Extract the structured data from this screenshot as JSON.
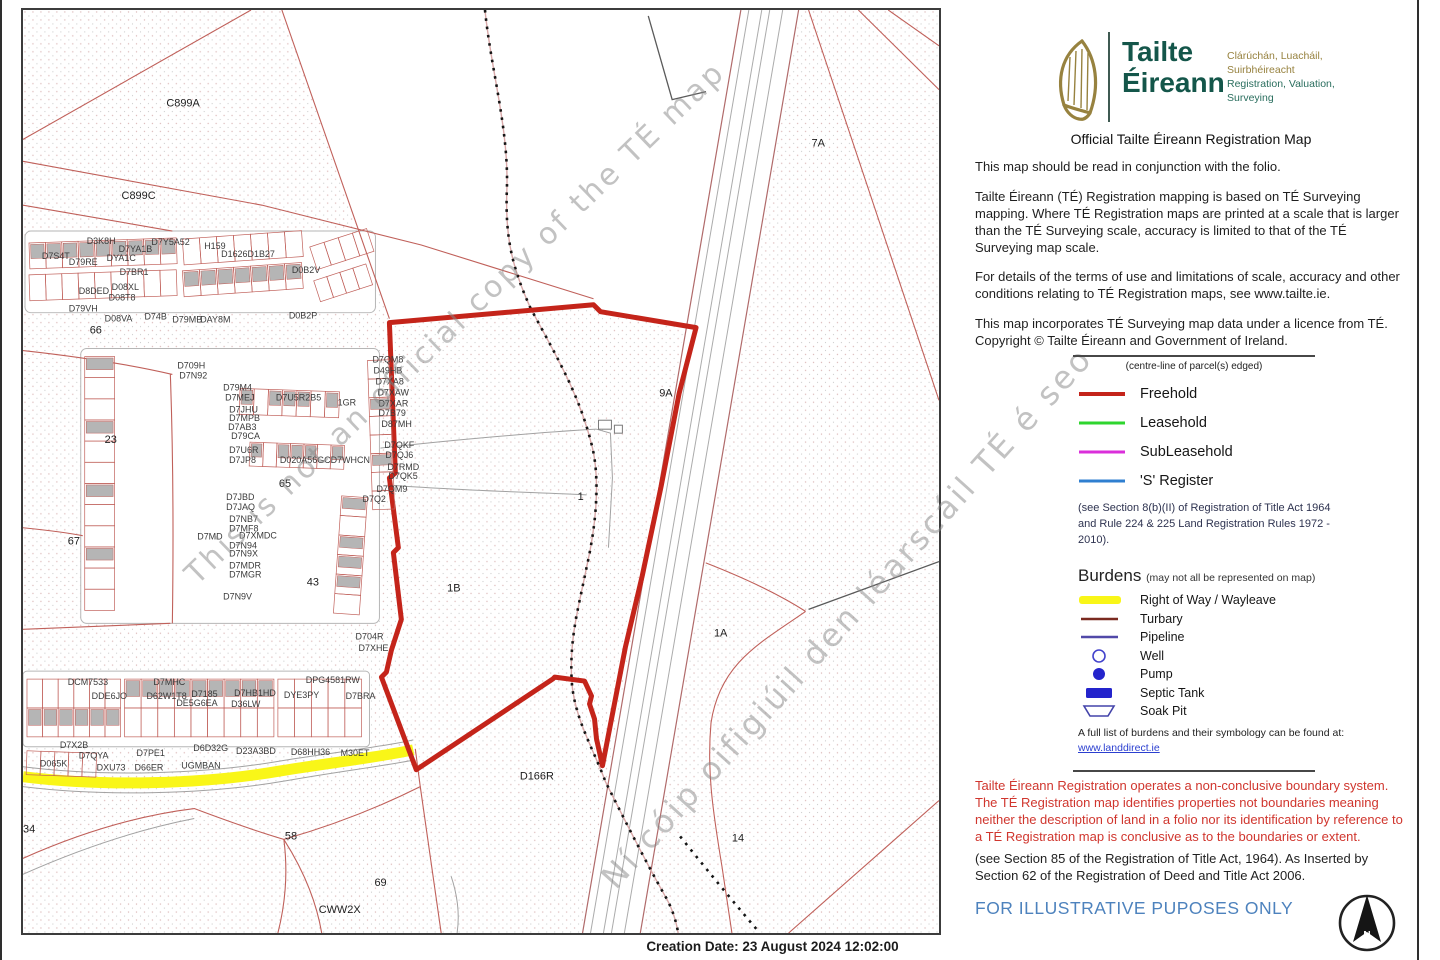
{
  "colors": {
    "freehold": "#c4241a",
    "leasehold": "#2ed52e",
    "subleasehold": "#da2eda",
    "s_register": "#2f7fd0",
    "row_yellow": "#f9f618",
    "turbary": "#7a2a20",
    "pipeline": "#5149a8",
    "burden_blue": "#2424cc",
    "brand_green": "#14564a",
    "brand_gold": "#97823f",
    "warning_red": "#d0362e",
    "illustrative_blue": "#4d82bd",
    "map_line_red": "#c0605a",
    "building_gray": "#b5b5b5",
    "link_blue": "#2b3fd0"
  },
  "header": {
    "brand_line1": "Tailte",
    "brand_line2": "Éireann",
    "tagline_ir1": "Clárúchán, Luacháil,",
    "tagline_ir2": "Suirbhéireacht",
    "tagline_en1": "Registration, Valuation,",
    "tagline_en2": "Surveying",
    "title": "Official Tailte Éireann Registration Map"
  },
  "paragraphs": {
    "p1": "This map should be read in conjunction with the folio.",
    "p2": "Tailte Éireann (TÉ) Registration mapping is based on TÉ Surveying mapping. Where TÉ Registration maps are printed at a scale that is larger than the TÉ Surveying scale, accuracy is limited to that of the TÉ Surveying map scale.",
    "p3": "For details of the terms of use and limitations of scale, accuracy and other conditions relating to TÉ Registration maps, see www.tailte.ie.",
    "p4": "This map incorporates TÉ Surveying map data under a licence from TÉ. Copyright © Tailte Éireann and Government of Ireland."
  },
  "legend": {
    "subtitle": "(centre-line of parcel(s) edged)",
    "items": [
      {
        "label": "Freehold",
        "color_key": "freehold",
        "w": 4
      },
      {
        "label": "Leasehold",
        "color_key": "leasehold",
        "w": 3
      },
      {
        "label": "SubLeasehold",
        "color_key": "subleasehold",
        "w": 3
      },
      {
        "label": "'S' Register",
        "color_key": "s_register",
        "w": 3
      }
    ],
    "note": "(see Section 8(b)(II) of Registration of Title Act 1964 and Rule 224 & 225 Land Registration Rules 1972 - 2010)."
  },
  "burdens": {
    "heading": "Burdens",
    "heading_note": "(may not all be represented on map)",
    "items": [
      {
        "label": "Right of Way / Wayleave",
        "sym": "yellow"
      },
      {
        "label": "Turbary",
        "sym": "turbary"
      },
      {
        "label": "Pipeline",
        "sym": "pipeline"
      },
      {
        "label": "Well",
        "sym": "well"
      },
      {
        "label": "Pump",
        "sym": "pump"
      },
      {
        "label": "Septic Tank",
        "sym": "septic"
      },
      {
        "label": "Soak Pit",
        "sym": "soak"
      }
    ],
    "footer_text": "A full list of burdens and their symbology can be found at:",
    "link": "www.landdirect.ie"
  },
  "notices": {
    "warning": "Tailte Éireann Registration operates a non-conclusive boundary system. The TÉ Registration map identifies properties not boundaries meaning neither the description of land in a folio nor its identification by reference to a TÉ Registration map is conclusive as to the boundaries or extent.",
    "statute": "(see Section 85 of the Registration of Title Act, 1964). As Inserted by Section 62 of the Registration of Deed and Title Act 2006.",
    "illustrative": "FOR ILLUSTRATIVE PUPOSES ONLY"
  },
  "compass": {
    "label": "N"
  },
  "footer": {
    "creation": "Creation Date: 23 August 2024 12:02:00"
  },
  "map": {
    "watermark1": "This is not an official copy of the TÉ map",
    "watermark2": "Ní cóip oifigiúil den léarscáil TÉ é seo",
    "area_labels": [
      [
        "C899A",
        144,
        97,
        12
      ],
      [
        "C899C",
        99,
        190,
        12
      ],
      [
        "7A",
        792,
        137
      ],
      [
        "66",
        67,
        325
      ],
      [
        "23",
        82,
        435
      ],
      [
        "67",
        45,
        537
      ],
      [
        "65",
        257,
        479
      ],
      [
        "43",
        285,
        578
      ],
      [
        "9A",
        639,
        388
      ],
      [
        "1",
        557,
        492
      ],
      [
        "1B",
        426,
        584
      ],
      [
        "1A",
        694,
        629
      ],
      [
        "D166R",
        499,
        773
      ],
      [
        "14",
        712,
        835
      ],
      [
        "58",
        263,
        833
      ],
      [
        "69",
        353,
        880
      ],
      [
        "CWW2X",
        297,
        907,
        10
      ],
      [
        "34",
        0,
        826
      ]
    ],
    "parcel_labels": [
      [
        "D3K8H",
        64,
        235
      ],
      [
        "D7YA1B",
        96,
        243
      ],
      [
        "D79RE",
        46,
        256
      ],
      [
        "DYA1C",
        84,
        252
      ],
      [
        "D7S4T",
        19,
        250
      ],
      [
        "D7BR1",
        97,
        266
      ],
      [
        "D7Y5A52",
        129,
        236
      ],
      [
        "H159",
        182,
        240
      ],
      [
        "D1626D1B27",
        199,
        248
      ],
      [
        "D0B2V",
        270,
        264
      ],
      [
        "D8DED",
        56,
        285
      ],
      [
        "D08XL",
        89,
        281
      ],
      [
        "D08T8",
        86,
        292
      ],
      [
        "D79VH",
        46,
        303
      ],
      [
        "D08VA",
        82,
        313
      ],
      [
        "D74B",
        122,
        311
      ],
      [
        "D79MB",
        150,
        314
      ],
      [
        "DAY8M",
        178,
        314
      ],
      [
        "D0B2P",
        267,
        310
      ],
      [
        "D709H",
        155,
        360
      ],
      [
        "D7N92",
        157,
        370
      ],
      [
        "D79M4",
        201,
        382
      ],
      [
        "D7MEJ",
        203,
        392
      ],
      [
        "D7JHU",
        207,
        404
      ],
      [
        "D7MPB",
        207,
        413
      ],
      [
        "D7AB3",
        206,
        422
      ],
      [
        "D79CA",
        209,
        431
      ],
      [
        "D7U5R2B5",
        254,
        392
      ],
      [
        "1GR",
        316,
        397
      ],
      [
        "D7U6R",
        207,
        445
      ],
      [
        "D7JP8",
        207,
        455
      ],
      [
        "D020A56GC",
        258,
        455
      ],
      [
        "D7WHCN",
        309,
        455
      ],
      [
        "D7QM8",
        351,
        354
      ],
      [
        "D49HB",
        352,
        365
      ],
      [
        "D7XA8",
        354,
        376
      ],
      [
        "D7XAW",
        356,
        387
      ],
      [
        "D7XAR",
        357,
        398
      ],
      [
        "D7B79",
        357,
        408
      ],
      [
        "D87MH",
        360,
        419
      ],
      [
        "D7QKF",
        363,
        440
      ],
      [
        "D7QJ6",
        364,
        450
      ],
      [
        "D7RMD",
        366,
        462
      ],
      [
        "D7QK5",
        367,
        471
      ],
      [
        "D7QM9",
        355,
        484
      ],
      [
        "D7Q2",
        341,
        494
      ],
      [
        "D7JBD",
        204,
        492
      ],
      [
        "D7JAQ",
        204,
        502
      ],
      [
        "D7NB7",
        207,
        514
      ],
      [
        "D7MF8",
        207,
        524
      ],
      [
        "D7MD",
        175,
        532
      ],
      [
        "D7XMDC",
        217,
        531
      ],
      [
        "D7N94",
        207,
        541
      ],
      [
        "D7N9X",
        207,
        549
      ],
      [
        "D7MDR",
        207,
        561
      ],
      [
        "D7MGR",
        207,
        570
      ],
      [
        "D7N9V",
        201,
        592
      ],
      [
        "D704R",
        334,
        632
      ],
      [
        "D7XHE",
        337,
        644
      ],
      [
        "DCM7533",
        45,
        678
      ],
      [
        "D7MHC",
        131,
        678
      ],
      [
        "DPG4581RW",
        284,
        676
      ],
      [
        "DDE6JO",
        69,
        692
      ],
      [
        "D62W1T8",
        124,
        692
      ],
      [
        "D7185",
        169,
        690
      ],
      [
        "D7HB1HD",
        212,
        689
      ],
      [
        "DYE3PY",
        262,
        691
      ],
      [
        "D7BRA",
        324,
        692
      ],
      [
        "DE5G6EA",
        154,
        699
      ],
      [
        "D36LW",
        209,
        700
      ],
      [
        "D7X2B",
        37,
        741
      ],
      [
        "D7QYA",
        56,
        752
      ],
      [
        "D7PE1",
        114,
        749
      ],
      [
        "D6D32G",
        171,
        744
      ],
      [
        "D23A3BD",
        214,
        747
      ],
      [
        "D68HH36",
        269,
        748
      ],
      [
        "M30ET",
        319,
        749
      ],
      [
        "D065K",
        17,
        760
      ],
      [
        "DXU73",
        74,
        764
      ],
      [
        "D66ER",
        112,
        764
      ],
      [
        "UGMBAN",
        159,
        762
      ]
    ]
  }
}
